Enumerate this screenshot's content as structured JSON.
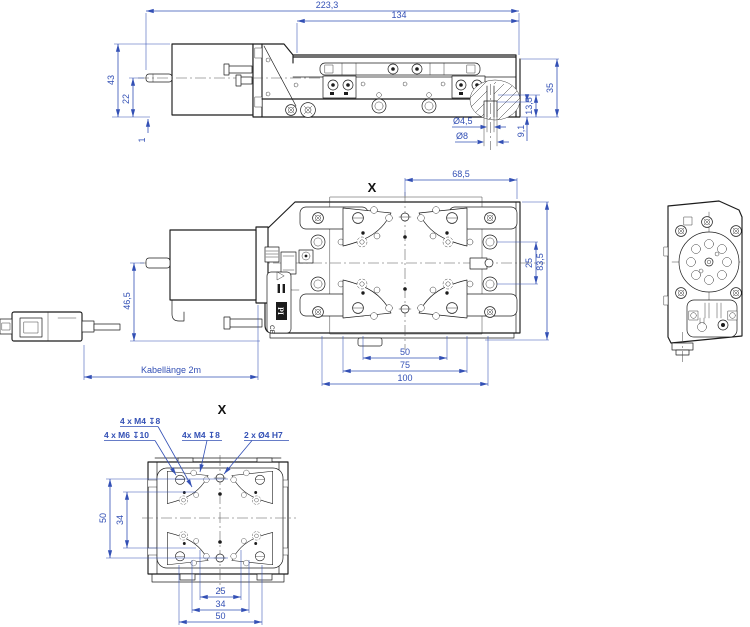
{
  "colors": {
    "dimension_blue": "#3350b5",
    "line_black": "#1c1c1c"
  },
  "side_view": {
    "dim_total_length": "223,3",
    "dim_platform_length": "134",
    "dim_motor_height": "43",
    "dim_axis_height": "22",
    "dim_base_gap": "1",
    "dim_stage_height": "35",
    "dim_counterbore_pos": "13,5",
    "dim_counterbore_depth": "9,1",
    "dim_hole_small": "Ø4,5",
    "dim_hole_large": "Ø8"
  },
  "plan_view": {
    "section_label": "X",
    "dim_hole_offset": "68,5",
    "dim_row_spacing": "25",
    "dim_body_width": "83,5",
    "dim_motor_offset": "46,5",
    "dim_cable": "Kabellänge 2m",
    "dim_holes_50": "50",
    "dim_holes_75": "75",
    "dim_holes_100": "100",
    "label_logo": "PI",
    "label_ce": "CE"
  },
  "bottom_view": {
    "section_label": "X",
    "callout_m4_top": "4 x M4 ↧8",
    "callout_m6": "4 x M6 ↧10",
    "callout_m4_mid": "4x M4 ↧8",
    "callout_fit": "2 x Ø4 H7",
    "dim_v50": "50",
    "dim_v34": "34",
    "dim_h25": "25",
    "dim_h34": "34",
    "dim_h50": "50"
  }
}
